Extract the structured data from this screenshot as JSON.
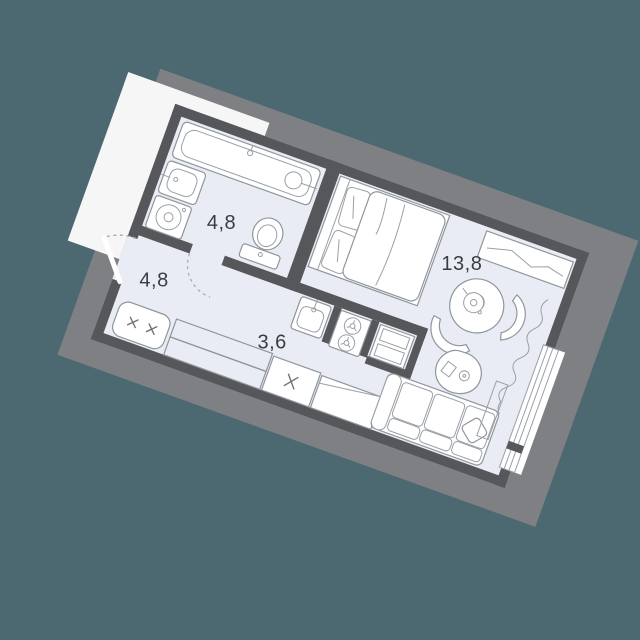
{
  "title": "Studio apartment floor plan",
  "colors": {
    "bg": "#4c6871",
    "wall": "#56575a",
    "floor": "#e9ecf4",
    "halo": "#7e8084",
    "line": "#8f969c",
    "line2": "#9aa0a6",
    "label": "#3a3d40",
    "dash_out": "#b4aaa2",
    "dash_in": "#a8aeb4"
  },
  "rooms": [
    {
      "id": "bathroom",
      "area_label": "4,8"
    },
    {
      "id": "hallway",
      "area_label": "4,8"
    },
    {
      "id": "kitchen",
      "area_label": "3,6"
    },
    {
      "id": "living-room",
      "area_label": "13,8"
    }
  ],
  "fixtures": [
    "bathtub",
    "washbasin",
    "washing-machine",
    "toilet",
    "kitchen-sink",
    "hob-2-burners",
    "fridge-column",
    "shoe-bench",
    "wardrobe-hatched",
    "wardrobe-cabinet",
    "sideboard",
    "double-bed",
    "desk-console",
    "round-table",
    "kettle",
    "chair",
    "chair",
    "coffee-table",
    "sofa",
    "throw-pillow",
    "radiator",
    "curtain",
    "window",
    "entrance-door-swing",
    "bathroom-door-swing"
  ]
}
